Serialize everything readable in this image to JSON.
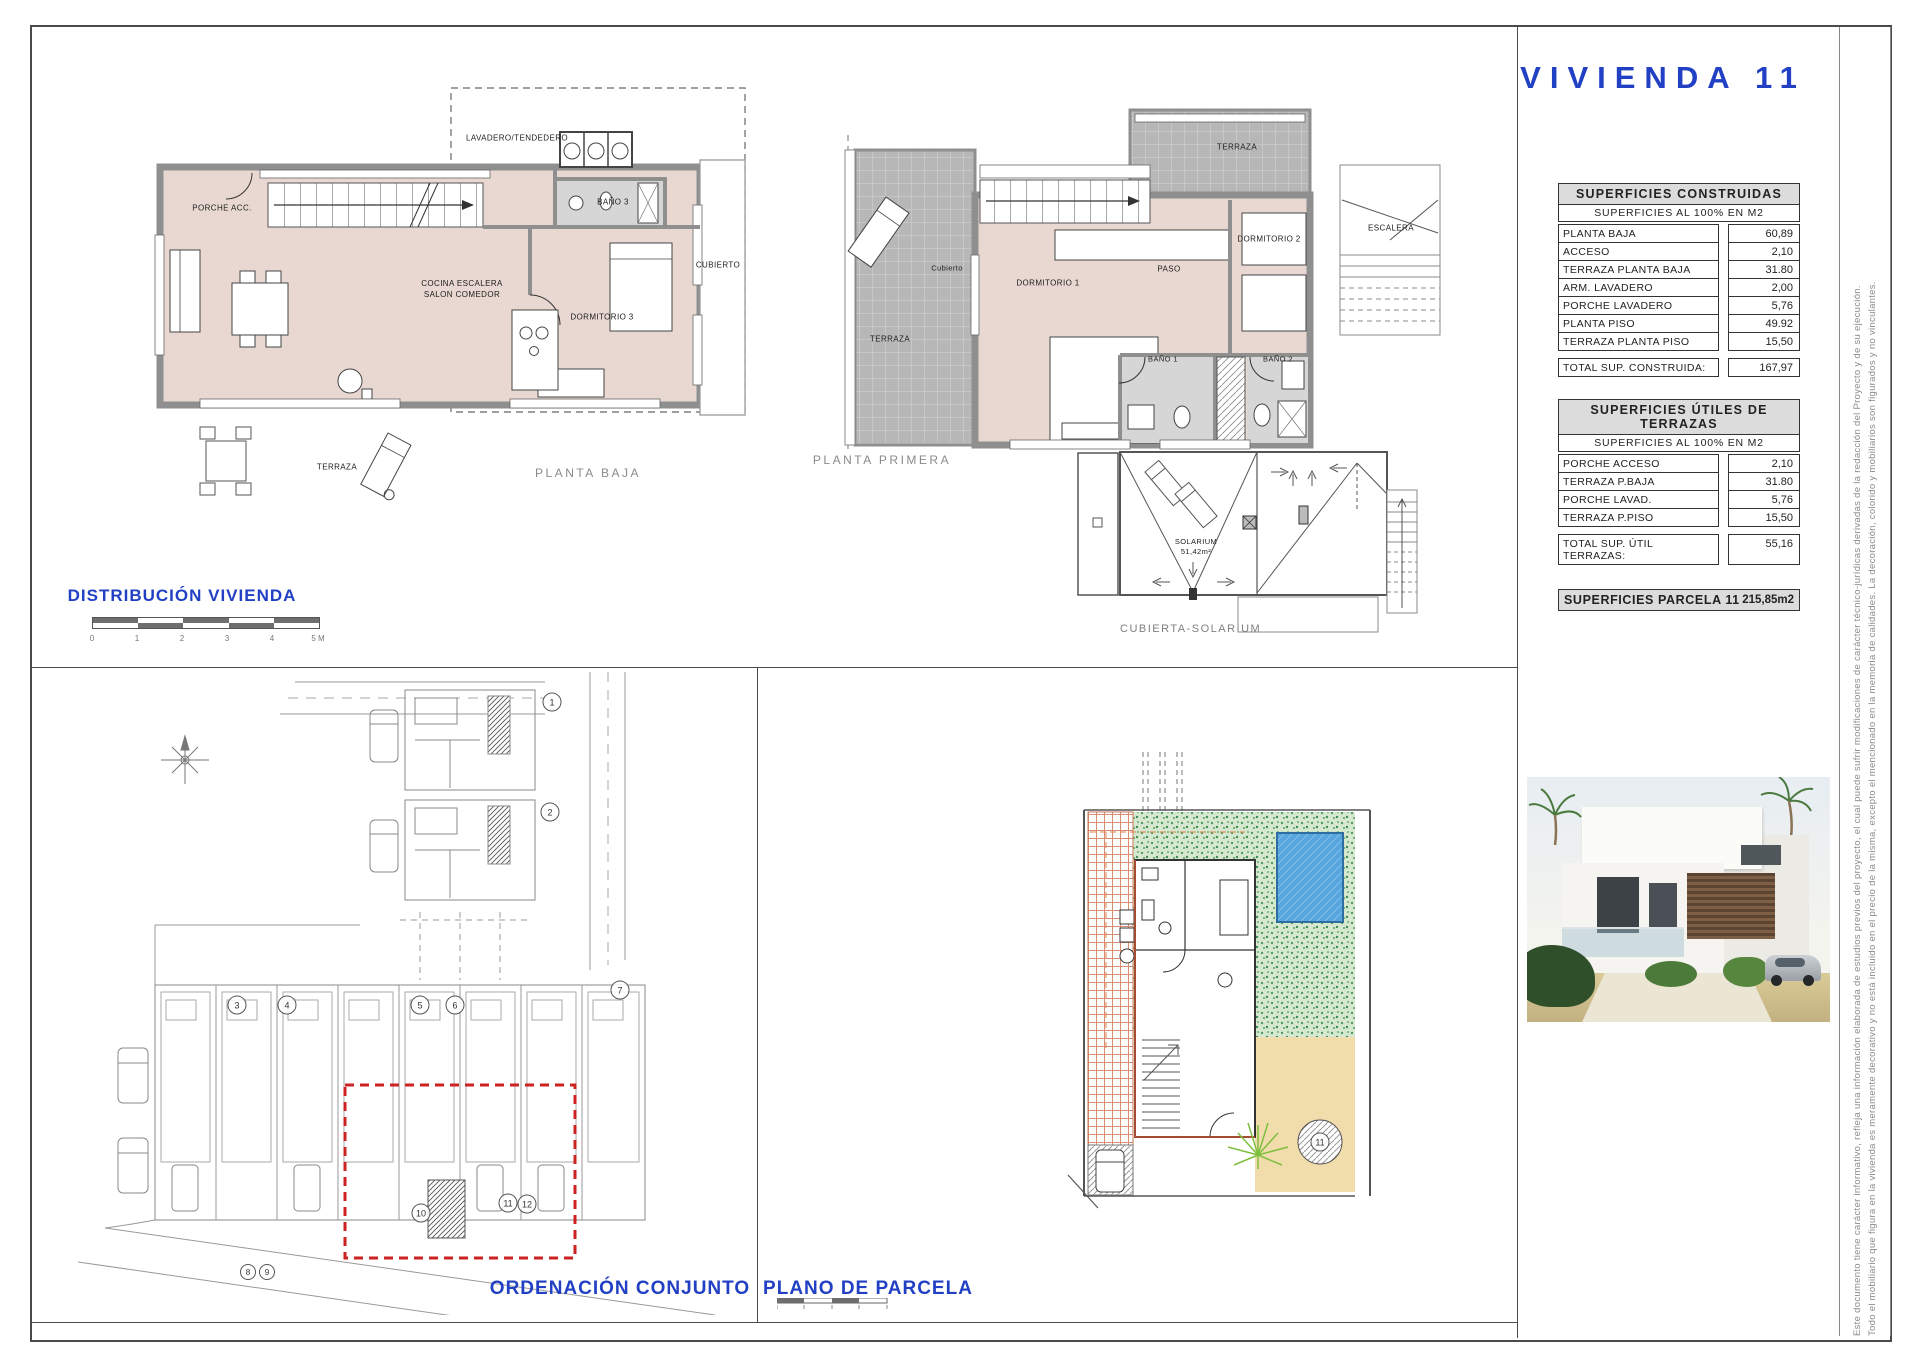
{
  "sheet": {
    "title": "VIVIENDA  11"
  },
  "floor_plans": {
    "planta_baja": {
      "label": "PLANTA BAJA",
      "rooms": {
        "porche": "PORCHE ACC.",
        "lavadero": "LAVADERO/TENDEDERO",
        "bano3": "BAÑO 3",
        "cubierto": "CUBIERTO",
        "cocina_salon": "COCINA ESCALERA\nSALON COMEDOR",
        "dormitorio3": "DORMITORIO 3",
        "terraza": "TERRAZA"
      }
    },
    "planta_primera": {
      "label": "PLANTA PRIMERA",
      "rooms": {
        "terraza_cubierto": "Cubierto",
        "terraza": "TERRAZA",
        "terraza_superior": "TERRAZA",
        "dormitorio1": "DORMITORIO 1",
        "paso": "PASO",
        "dormitorio2": "DORMITORIO 2",
        "bano1": "BAÑO 1",
        "bano2": "BAÑO 2",
        "escalera": "ESCALERA"
      }
    },
    "cubierta": {
      "label": "CUBIERTA-SOLARIUM",
      "solarium": "SOLARIUM\n51,42m²"
    },
    "distribucion": {
      "label": "DISTRIBUCIÓN  VIVIENDA",
      "scale_ticks": [
        "0",
        "1",
        "2",
        "3",
        "4",
        "5 M"
      ]
    }
  },
  "site_plans": {
    "ordenacion": {
      "label": "ORDENACIÓN CONJUNTO",
      "unit_numbers": [
        "1",
        "2",
        "3",
        "4",
        "5",
        "6",
        "7",
        "8",
        "9",
        "10",
        "11",
        "12"
      ]
    },
    "parcela": {
      "label": "PLANO DE PARCELA",
      "unit_number": "11"
    }
  },
  "tables": {
    "construidas": {
      "title": "SUPERFICIES  CONSTRUIDAS",
      "subtitle": "SUPERFICIES  AL  100%  EN  M2",
      "rows": [
        {
          "label": "PLANTA  BAJA",
          "value": "60,89"
        },
        {
          "label": "ACCESO",
          "value": "2,10"
        },
        {
          "label": "TERRAZA  PLANTA  BAJA",
          "value": "31.80"
        },
        {
          "label": "ARM.  LAVADERO",
          "value": "2,00"
        },
        {
          "label": "PORCHE  LAVADERO",
          "value": "5,76"
        },
        {
          "label": "PLANTA  PISO",
          "value": "49.92"
        },
        {
          "label": "TERRAZA  PLANTA  PISO",
          "value": "15,50"
        }
      ],
      "total": {
        "label": "TOTAL  SUP.  CONSTRUIDA:",
        "value": "167,97"
      }
    },
    "terrazas": {
      "title": "SUPERFICIES  ÚTILES  DE  TERRAZAS",
      "subtitle": "SUPERFICIES  AL  100%  EN  M2",
      "rows": [
        {
          "label": "PORCHE  ACCESO",
          "value": "2,10"
        },
        {
          "label": "TERRAZA  P.BAJA",
          "value": "31.80"
        },
        {
          "label": "PORCHE  LAVAD.",
          "value": "5,76"
        },
        {
          "label": "TERRAZA  P.PISO",
          "value": "15,50"
        }
      ],
      "total": {
        "label": "TOTAL  SUP.  ÚTIL  TERRAZAS:",
        "value": "55,16"
      }
    },
    "parcela": {
      "label": "SUPERFICIES  PARCELA  11",
      "value": "215,85m2"
    }
  },
  "disclaimer": {
    "line1": "Este documento tiene carácter informativo, refleja una información elaborada de estudios previos del proyecto, el cual puede sufrir modificaciones de carácter técnico-jurídicas derivadas de la redacción del Proyecto y de su ejecución.",
    "line2": "Todo el mobiliario que figura en la vivienda es meramente decorativo y no está incluido en el precio de la misma, excepto el mencionado en la memoria de calidades. La decoración, colorido y mobiliarios son figurados y no vinculantes."
  },
  "colors": {
    "accent_blue": "#2140c4",
    "label_gray": "#8a8a8a",
    "floor_pink": "#e9d8d1",
    "wall_gray": "#8f8f8f",
    "tile_gray": "#b7b7b7",
    "table_header_bg": "#dcdcdc",
    "highlight_red": "#cc2222",
    "pool_blue": "#57a6dd",
    "grass_green": "#55a061",
    "sand_tan": "#f1dcab",
    "brick_salmon": "#d98d6e"
  }
}
